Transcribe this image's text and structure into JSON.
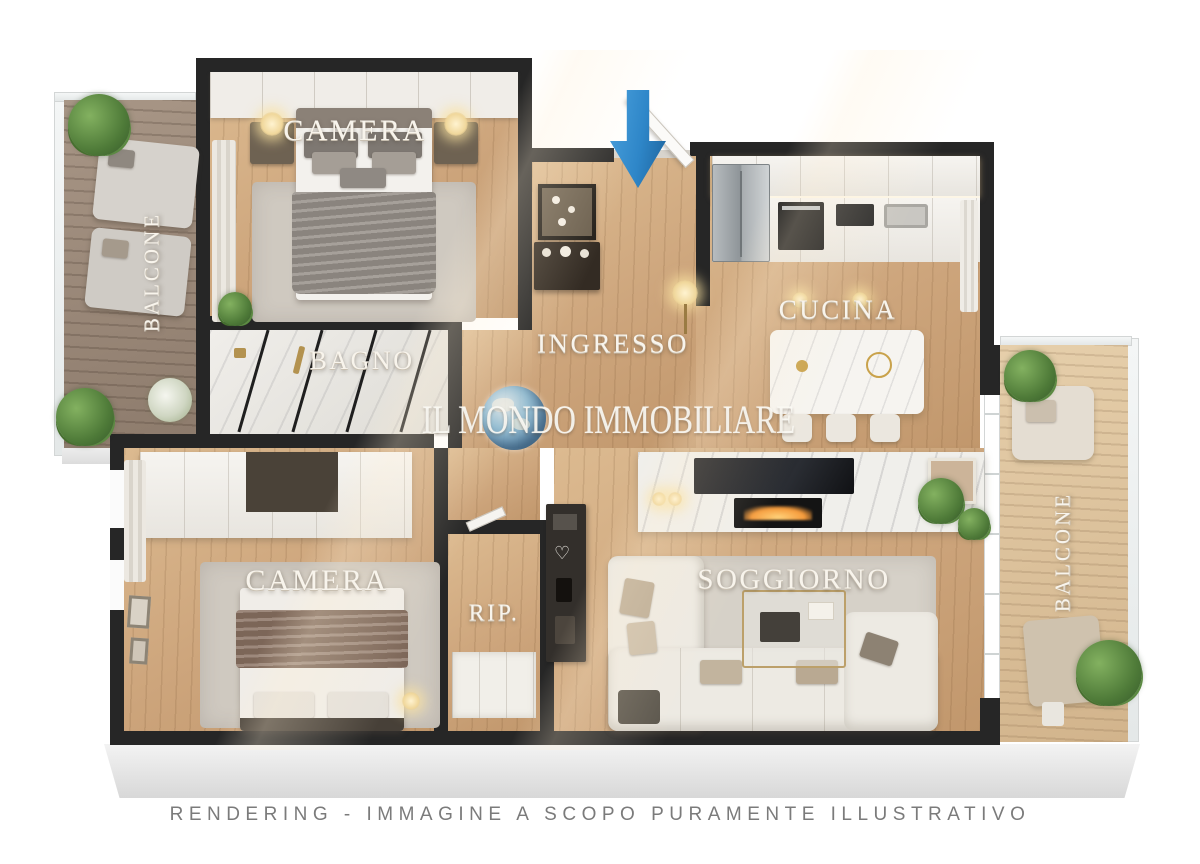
{
  "branding": {
    "watermark_text": "IL MONDO IMMOBILIARE",
    "watermark_icon": "globe-icon",
    "disclaimer": "RENDERING - IMMAGINE A SCOPO PURAMENTE ILLUSTRATIVO"
  },
  "entrance": {
    "arrow_icon": "arrow-down-icon",
    "arrow_color": "#2e86c8"
  },
  "rooms": {
    "camera_top": {
      "label": "CAMERA"
    },
    "bagno": {
      "label": "BAGNO"
    },
    "ingresso": {
      "label": "INGRESSO"
    },
    "cucina": {
      "label": "CUCINA"
    },
    "camera_bottom": {
      "label": "CAMERA"
    },
    "ripostiglio": {
      "label": "RIP."
    },
    "soggiorno": {
      "label": "SOGGIORNO"
    },
    "balcone_left": {
      "label": "BALCONE"
    },
    "balcone_right": {
      "label": "BALCONE"
    }
  },
  "palette": {
    "wall": "#262626",
    "wood_floor": "#cfa87d",
    "deck_left": "#94826f",
    "deck_right": "#d9bc96",
    "marble": "#e9e7e3",
    "label_color": "#f8f4ec",
    "disclaimer_color": "#7b7b7b",
    "arrow_blue": "#2e86c8"
  }
}
